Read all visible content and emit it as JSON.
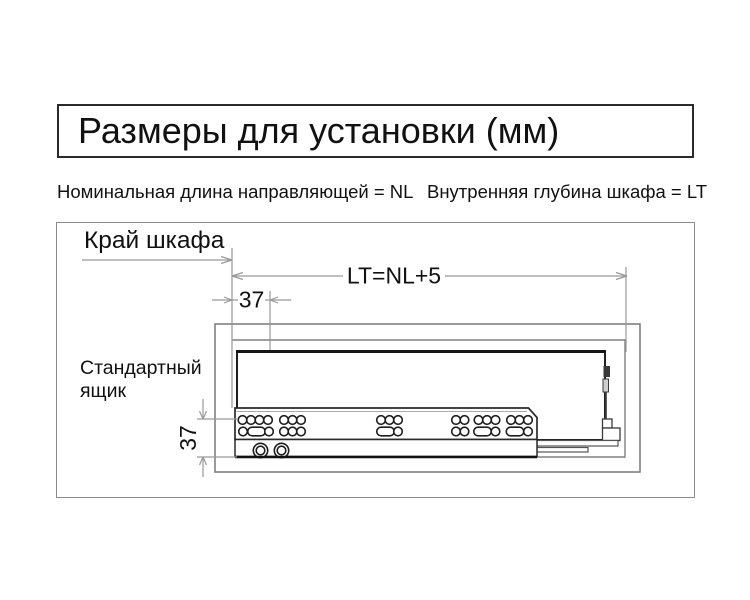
{
  "title": "Размеры для установки (мм)",
  "legend": {
    "nominal_length": "Номинальная длина направляющей = NL",
    "inner_depth": "Внутренняя глубина шкафа = LT"
  },
  "diagram": {
    "labels": {
      "cabinet_edge": "Край шкафа",
      "lt_formula": "LT=NL+5",
      "front_offset_mm": "37",
      "bottom_offset_mm": "37",
      "drawer_line1": "Стандартный",
      "drawer_line2": "ящик"
    },
    "colors": {
      "dimension_line": "#999999",
      "cabinet_outline": "#808080",
      "drawer_outline": "#1f1f1f",
      "rail_outline": "#2a2a2a",
      "text": "#111111"
    },
    "rail": {
      "hole_radius": 4.3,
      "oval_w": 17.5,
      "oval_h": 8.6,
      "top_row_y": 420,
      "bottom_row_y": 431.5,
      "hole_groups": [
        {
          "top": [
            242.5,
            251,
            259.5,
            268
          ],
          "bottom": [
            {
              "t": "c",
              "x": 243
            },
            {
              "t": "o",
              "x": 256.5
            },
            {
              "t": "c",
              "x": 269
            }
          ]
        },
        {
          "top": [
            284,
            292.5,
            301
          ],
          "bottom": [
            {
              "t": "c",
              "x": 284
            },
            {
              "t": "c",
              "x": 292.5
            },
            {
              "t": "c",
              "x": 301
            }
          ]
        },
        {
          "top": [
            381,
            389.5,
            398
          ],
          "bottom": [
            {
              "t": "o",
              "x": 385.5
            },
            {
              "t": "c",
              "x": 398
            }
          ]
        },
        {
          "top": [
            456,
            464.5
          ],
          "bottom": [
            {
              "t": "c",
              "x": 456
            },
            {
              "t": "c",
              "x": 464.5
            }
          ]
        },
        {
          "top": [
            478.5,
            487,
            495.5
          ],
          "bottom": [
            {
              "t": "o",
              "x": 482.5
            },
            {
              "t": "c",
              "x": 495.5
            }
          ]
        },
        {
          "top": [
            511,
            519.5,
            528
          ],
          "bottom": [
            {
              "t": "o",
              "x": 515
            },
            {
              "t": "c",
              "x": 528
            }
          ]
        }
      ],
      "rivets": [
        {
          "x": 260.5,
          "y": 450.5
        },
        {
          "x": 281.5,
          "y": 450.5
        }
      ]
    }
  }
}
